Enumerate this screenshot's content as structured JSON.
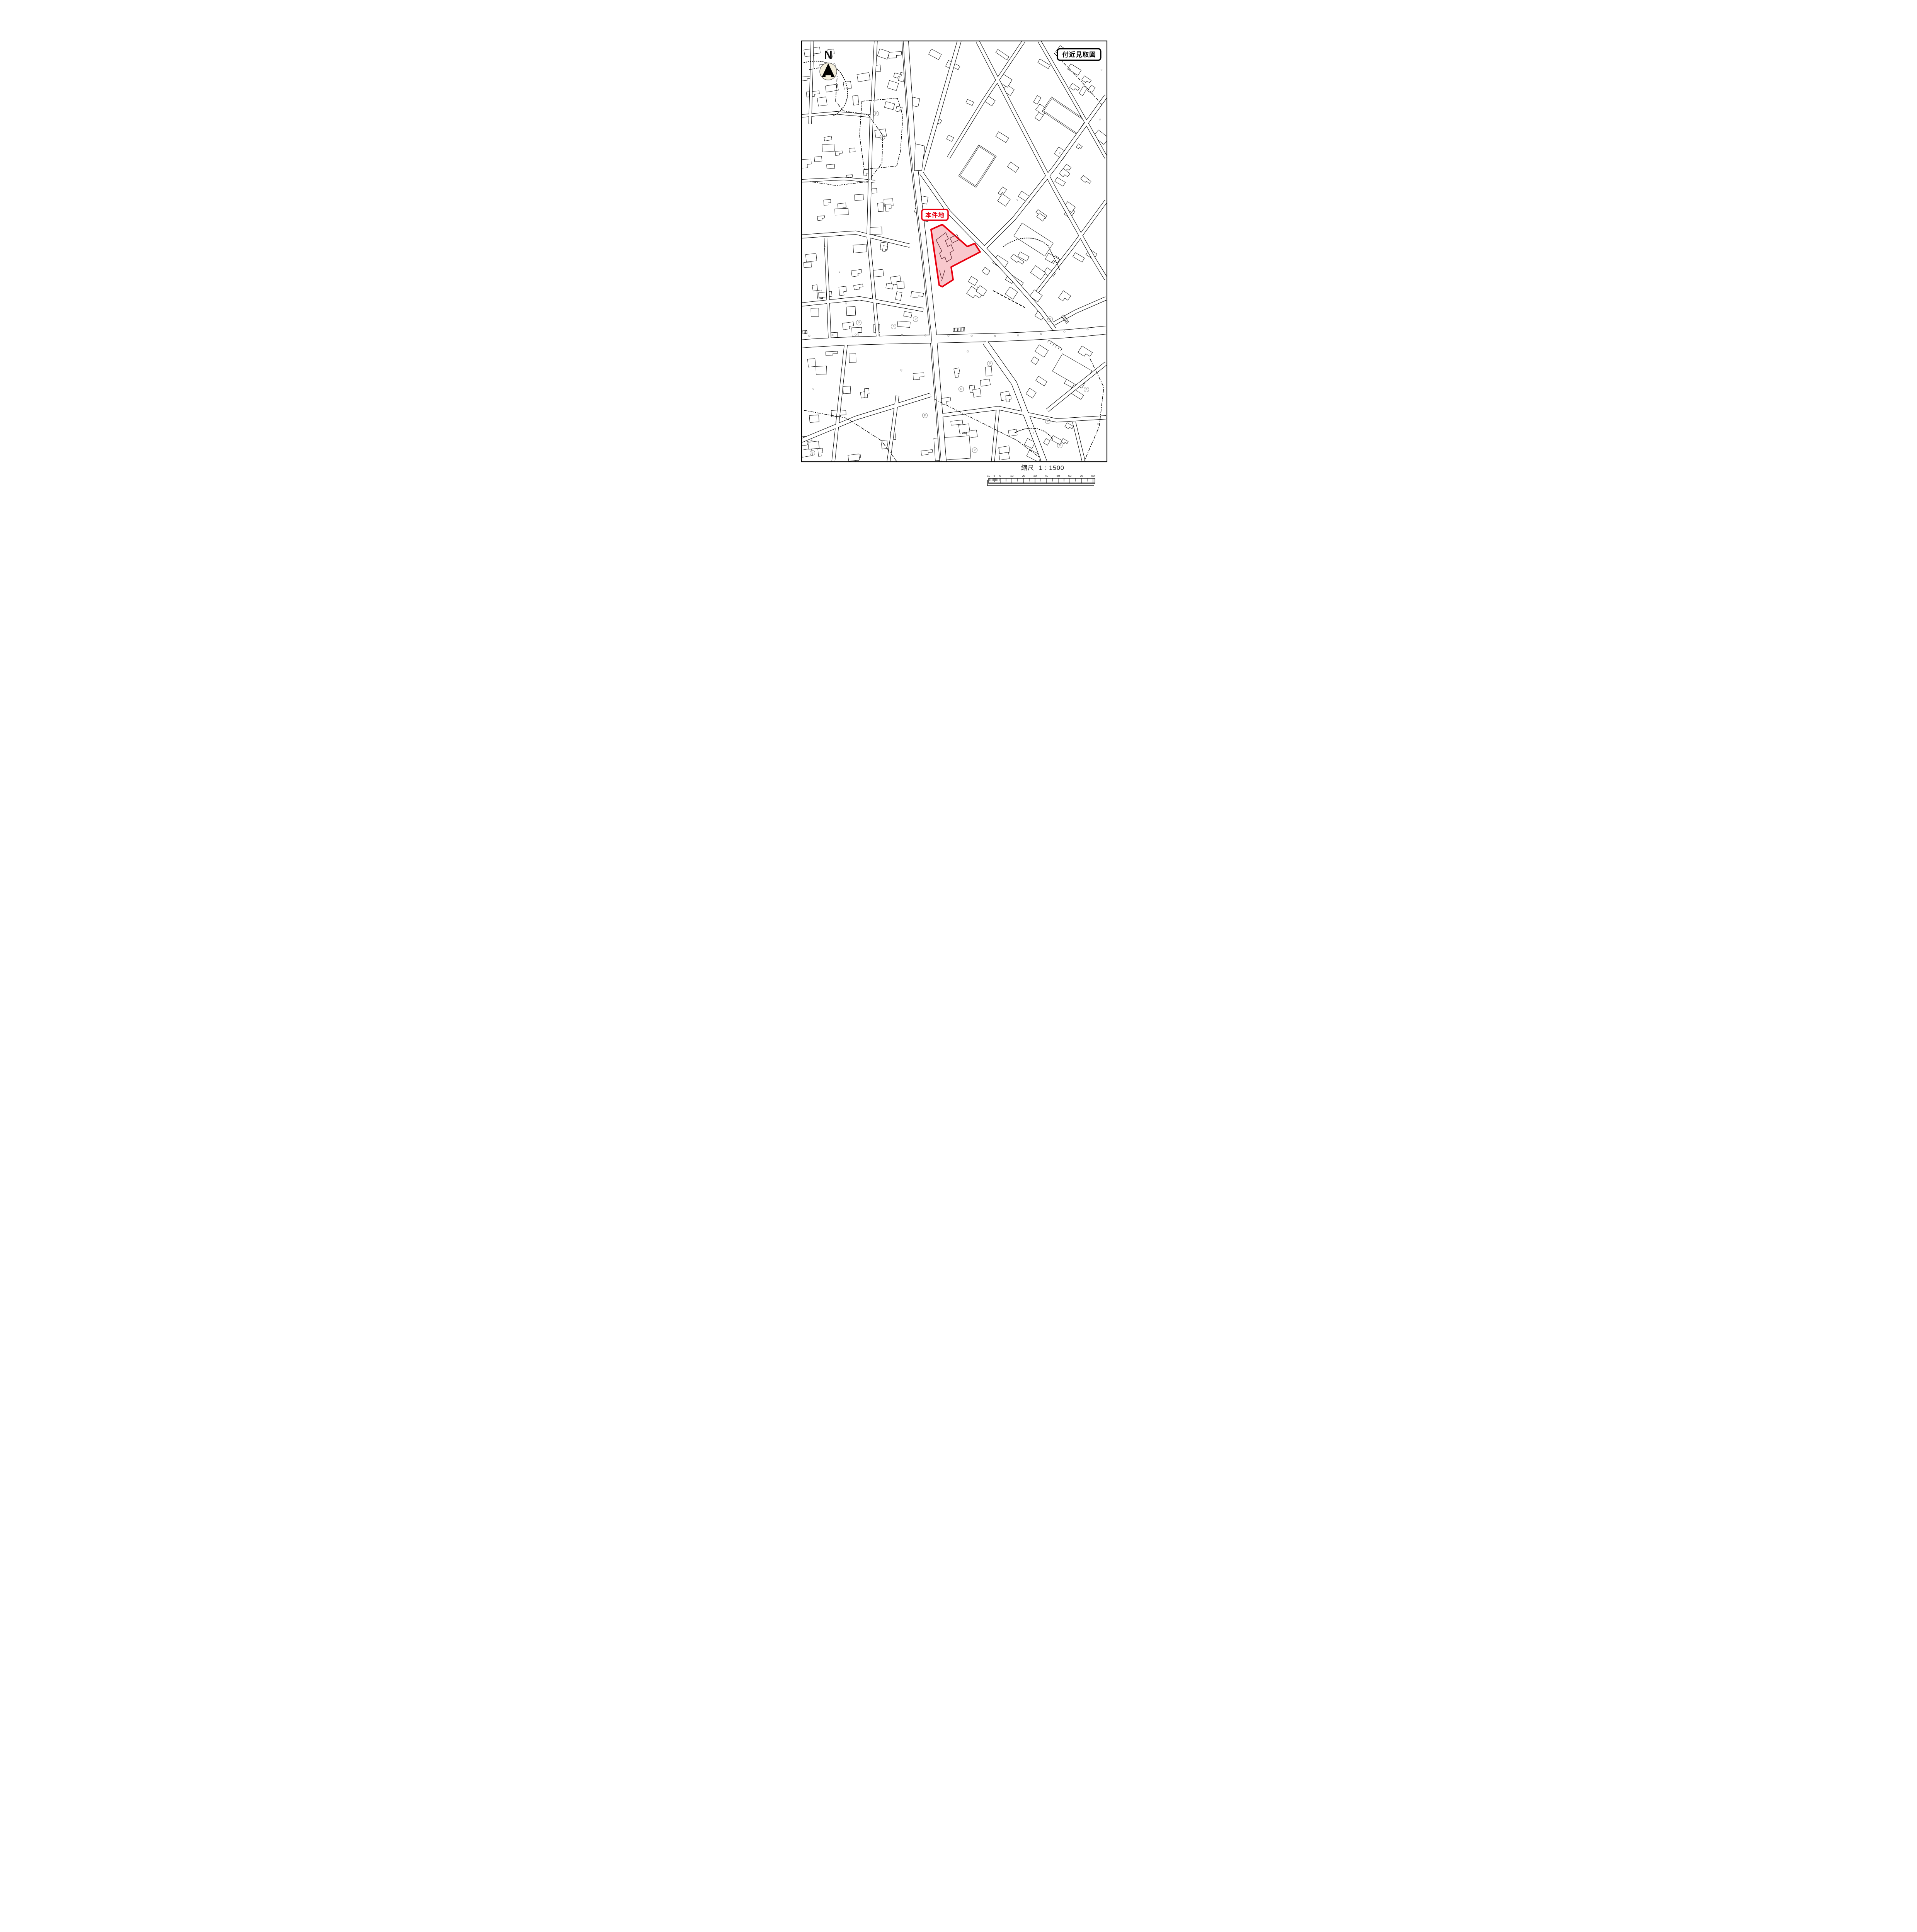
{
  "title_box": {
    "label": "付近見取図"
  },
  "north": {
    "label": "N"
  },
  "site": {
    "label": "本件地"
  },
  "scale": {
    "label": "縮尺",
    "ratio": "1 : 1500",
    "left_labels": [
      "10",
      "5",
      "0"
    ],
    "main_labels": [
      "10",
      "20",
      "30",
      "40",
      "50",
      "60",
      "70",
      "80"
    ]
  },
  "symbols": {
    "parking": "P",
    "utility": "Q",
    "light": "☼",
    "check": "∨"
  },
  "colors": {
    "site_fill": "#F8C8CD",
    "site_stroke": "#E8000F",
    "map_line": "#000000",
    "symbol_gray": "#8C8C8C"
  }
}
